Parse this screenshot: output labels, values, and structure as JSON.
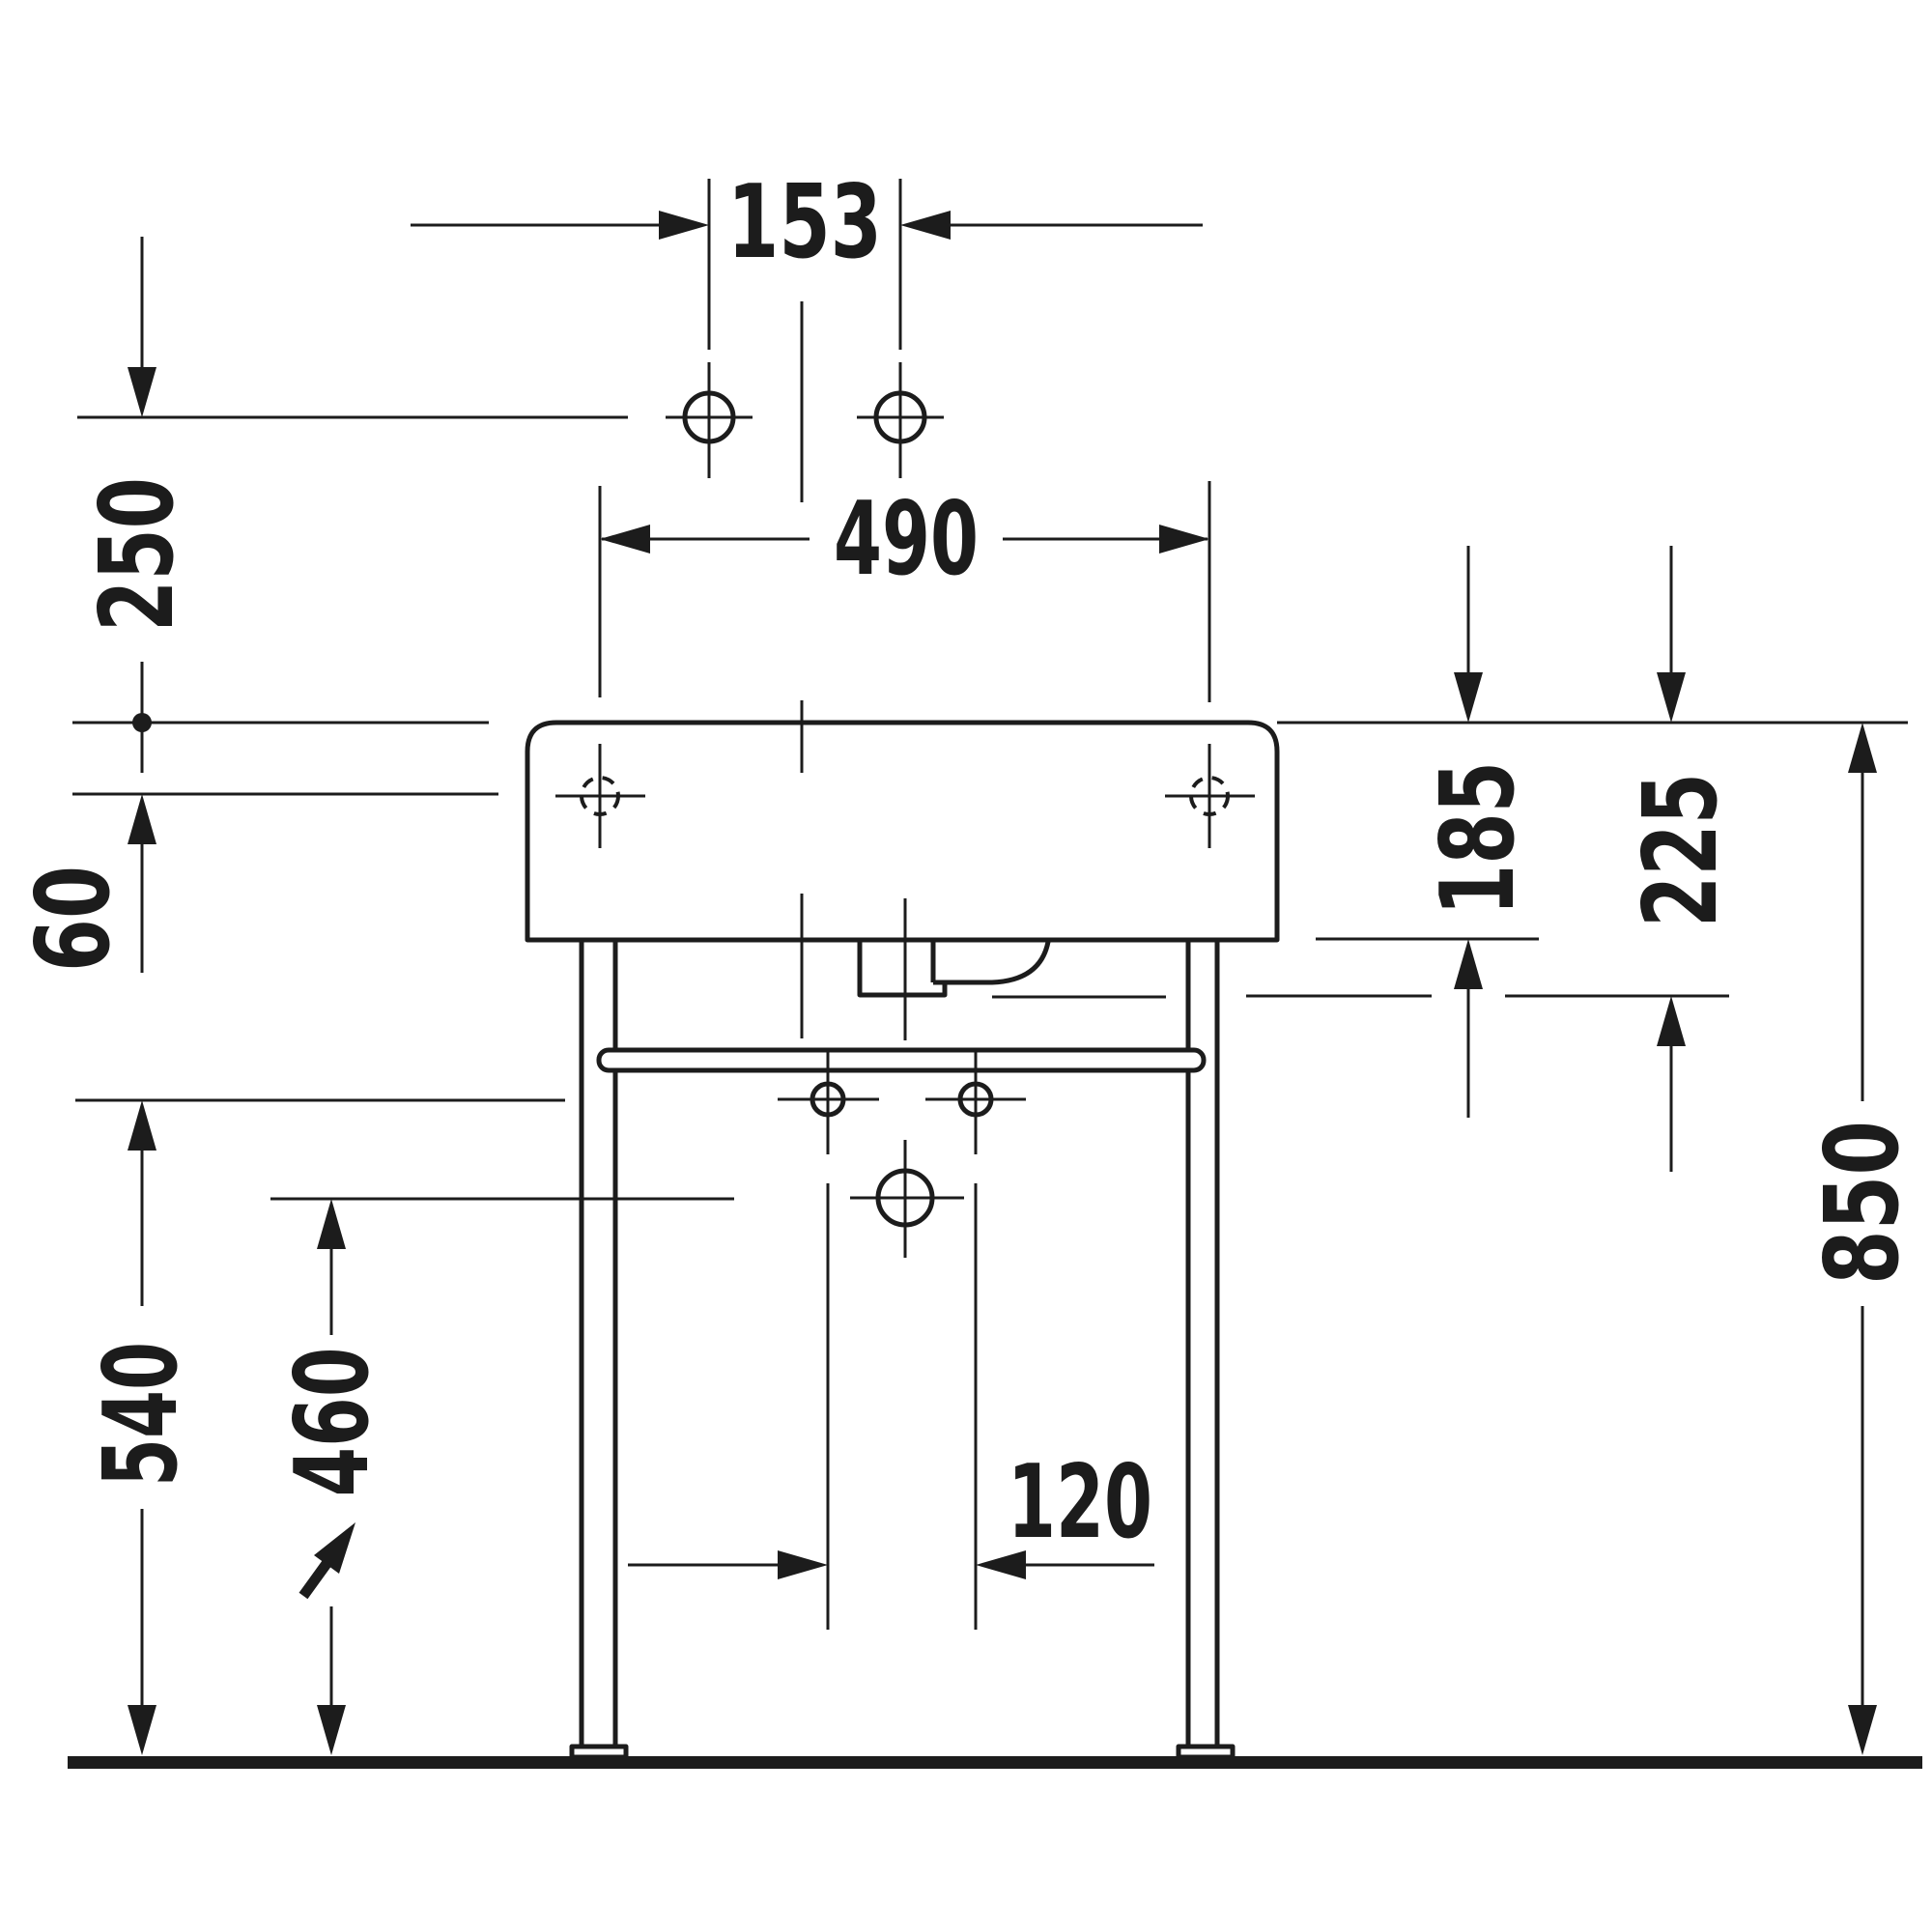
{
  "drawing": {
    "type": "washbasin-console-front-view-dimension-drawing",
    "ink_color": "#1c1c1c",
    "background_color": "#ffffff",
    "dimensions": {
      "faucet_hole_spacing": "153",
      "mounting_hole_spacing": "490",
      "faucet_line_offset": "250",
      "rim_to_mounting_hole": "60",
      "rim_to_bottom_edge": "185",
      "rim_to_drain_bottom": "225",
      "rim_height": "850",
      "lower_hole_height": "540",
      "drain_outlet_height": "460",
      "lower_hole_spacing": "120"
    }
  }
}
